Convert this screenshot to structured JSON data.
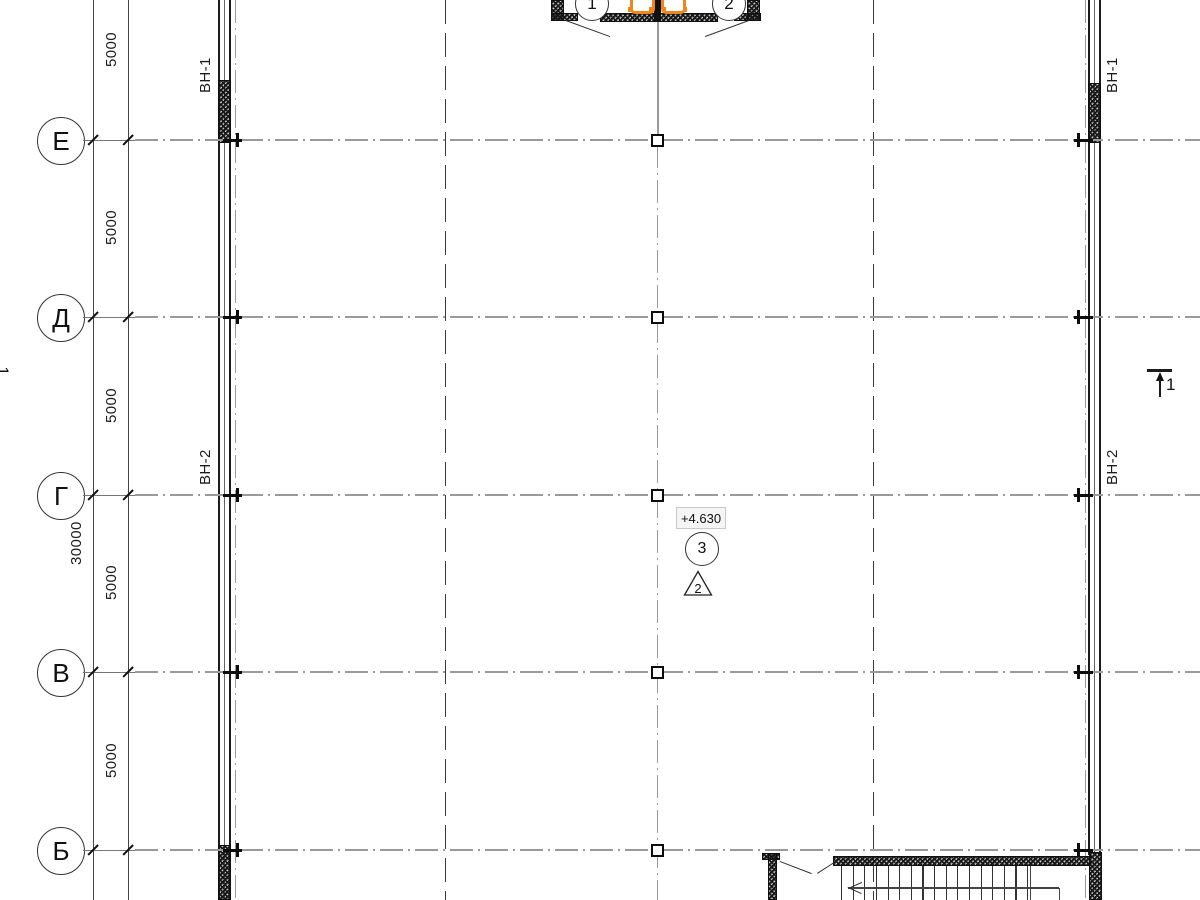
{
  "drawing": {
    "type": "floor-plan",
    "axes": {
      "rows": [
        {
          "label": "Е",
          "y": 140
        },
        {
          "label": "Д",
          "y": 317
        },
        {
          "label": "Г",
          "y": 495
        },
        {
          "label": "В",
          "y": 672
        },
        {
          "label": "Б",
          "y": 850
        }
      ]
    },
    "dimensions": {
      "segments": [
        {
          "label": "5000",
          "mid": 50
        },
        {
          "label": "5000",
          "mid": 228
        },
        {
          "label": "5000",
          "mid": 406
        },
        {
          "label": "5000",
          "mid": 583
        },
        {
          "label": "5000",
          "mid": 761
        }
      ],
      "total": {
        "label": "30000",
        "mid": 543
      }
    },
    "wall_labels": {
      "left_top": "ВН-1",
      "left_mid": "ВН-2",
      "right_top": "ВН-1",
      "right_mid": "ВН-2"
    },
    "entrance": {
      "bubble_left": "1",
      "bubble_right": "2"
    },
    "annotations": {
      "elevation": "+4.630",
      "node_number": "3",
      "detail_number": "2"
    },
    "section_marks": {
      "right": "1",
      "left": "1"
    },
    "colors": {
      "accent_orange": "#F08519",
      "axis_gray": "#9A9A9A",
      "line_dark": "#1C1C1C"
    }
  }
}
